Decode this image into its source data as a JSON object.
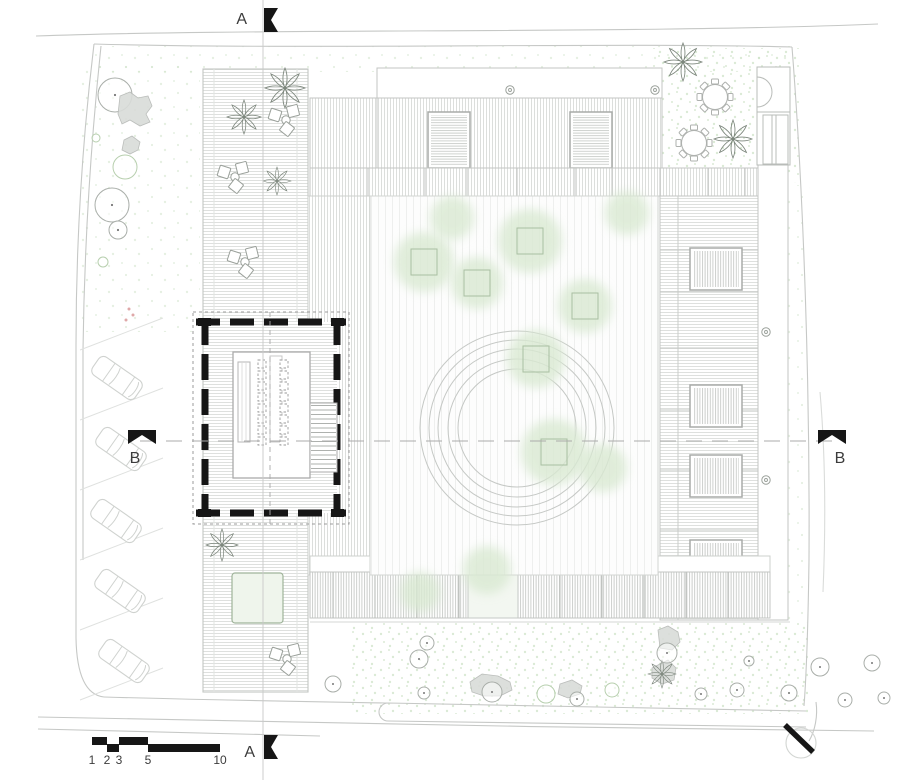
{
  "document": {
    "type": "architectural-site-plan"
  },
  "colors": {
    "black": "#161616",
    "line": "#b9bcb9",
    "light_line": "#d2d5d2",
    "faint_line": "#dfe1df",
    "boundary": "#c6c8c6",
    "canopy": "#d9e9d2",
    "stipple": "#cbe0c3",
    "planter": "#a9bfa2",
    "car": "#cfd2cf",
    "tree_ring": "#a9aea9",
    "tree_ring_green": "#b7cfae",
    "text": "#3c3c3c"
  },
  "markers": {
    "a_top": {
      "label": "A"
    },
    "a_bottom": {
      "label": "A"
    },
    "b_left": {
      "label": "B"
    },
    "b_right": {
      "label": "B"
    }
  },
  "scale_bar": {
    "marks": [
      {
        "label": "1",
        "x": 92
      },
      {
        "label": "2",
        "x": 107
      },
      {
        "label": "3",
        "x": 119
      },
      {
        "label": "5",
        "x": 148
      },
      {
        "label": "10",
        "x": 220
      }
    ],
    "segments": [
      {
        "x1": 92,
        "x2": 107,
        "row": "top"
      },
      {
        "x1": 107,
        "x2": 119,
        "row": "bottom"
      },
      {
        "x1": 119,
        "x2": 148,
        "row": "top"
      },
      {
        "x1": 148,
        "x2": 220,
        "row": "bottom"
      }
    ]
  },
  "parking": {
    "stalls": [
      [
        80,
        350,
        163,
        318
      ],
      [
        80,
        420,
        163,
        388
      ],
      [
        80,
        490,
        163,
        458
      ],
      [
        80,
        560,
        163,
        528
      ],
      [
        80,
        630,
        163,
        598
      ],
      [
        80,
        700,
        163,
        668
      ]
    ],
    "cars": [
      {
        "x": 117,
        "y": 378,
        "a": 35
      },
      {
        "x": 121,
        "y": 449,
        "a": 35
      },
      {
        "x": 116,
        "y": 521,
        "a": 35
      },
      {
        "x": 120,
        "y": 591,
        "a": 35
      },
      {
        "x": 124,
        "y": 661,
        "a": 35
      }
    ]
  },
  "landscape": {
    "courtyard_trees": [
      {
        "x": 424,
        "y": 262,
        "r": 30,
        "planter": true
      },
      {
        "x": 477,
        "y": 283,
        "r": 26,
        "planter": true
      },
      {
        "x": 530,
        "y": 241,
        "r": 32,
        "planter": true
      },
      {
        "x": 585,
        "y": 306,
        "r": 27,
        "planter": true
      },
      {
        "x": 536,
        "y": 359,
        "r": 29,
        "planter": true
      },
      {
        "x": 554,
        "y": 452,
        "r": 33,
        "planter": true
      },
      {
        "x": 452,
        "y": 218,
        "r": 22,
        "planter": false
      },
      {
        "x": 603,
        "y": 468,
        "r": 24,
        "planter": false
      },
      {
        "x": 627,
        "y": 213,
        "r": 22,
        "planter": false
      },
      {
        "x": 487,
        "y": 570,
        "r": 24,
        "planter": false
      },
      {
        "x": 420,
        "y": 592,
        "r": 20,
        "planter": false
      }
    ],
    "perimeter_trees": [
      {
        "x": 115,
        "y": 95,
        "r": 17,
        "dot": true
      },
      {
        "x": 112,
        "y": 205,
        "r": 17,
        "dot": true
      },
      {
        "x": 118,
        "y": 230,
        "r": 9,
        "dot": true
      },
      {
        "x": 125,
        "y": 167,
        "r": 12,
        "green": true
      },
      {
        "x": 103,
        "y": 262,
        "r": 5,
        "green": true
      },
      {
        "x": 96,
        "y": 138,
        "r": 4,
        "green": true
      }
    ],
    "garden_trees": [
      {
        "x": 427,
        "y": 643,
        "r": 7,
        "dot": true
      },
      {
        "x": 419,
        "y": 659,
        "r": 9,
        "dot": true
      },
      {
        "x": 333,
        "y": 684,
        "r": 8,
        "dot": true
      },
      {
        "x": 424,
        "y": 693,
        "r": 6,
        "dot": true
      },
      {
        "x": 492,
        "y": 692,
        "r": 10,
        "dot": true
      },
      {
        "x": 546,
        "y": 694,
        "r": 9,
        "green": true
      },
      {
        "x": 577,
        "y": 699,
        "r": 7,
        "dot": true
      },
      {
        "x": 612,
        "y": 690,
        "r": 7,
        "green": true
      },
      {
        "x": 667,
        "y": 653,
        "r": 10,
        "dot": true
      },
      {
        "x": 701,
        "y": 694,
        "r": 6,
        "dot": true
      },
      {
        "x": 737,
        "y": 690,
        "r": 7,
        "dot": true
      },
      {
        "x": 749,
        "y": 661,
        "r": 5,
        "dot": true
      },
      {
        "x": 789,
        "y": 693,
        "r": 8,
        "dot": true
      },
      {
        "x": 820,
        "y": 667,
        "r": 9,
        "dot": true
      },
      {
        "x": 845,
        "y": 700,
        "r": 7,
        "dot": true
      },
      {
        "x": 872,
        "y": 663,
        "r": 8,
        "dot": true
      },
      {
        "x": 884,
        "y": 698,
        "r": 6,
        "dot": true
      }
    ],
    "palms": [
      {
        "x": 285,
        "y": 88,
        "s": 1.0
      },
      {
        "x": 244,
        "y": 117,
        "s": 0.85
      },
      {
        "x": 277,
        "y": 181,
        "s": 0.7
      },
      {
        "x": 222,
        "y": 545,
        "s": 0.8
      },
      {
        "x": 683,
        "y": 62,
        "s": 0.95
      },
      {
        "x": 733,
        "y": 139,
        "s": 0.95
      },
      {
        "x": 662,
        "y": 674,
        "s": 0.7
      }
    ],
    "blobs": [
      "120,96 130,92 138,98 148,96 152,106 146,114 150,122 140,126 130,120 122,124 118,114",
      "124,140 132,136 140,142 138,150 130,154 122,150",
      "470,682 482,674 498,676 510,682 512,690 500,696 484,696 472,692",
      "560,684 572,680 582,686 580,694 568,698 558,694",
      "658,630 668,626 678,632 680,642 672,650 660,648",
      "652,668 668,660 676,668 674,680 662,684 652,678",
      "922,190 936,184 946,192 944,204 930,208 920,200"
    ],
    "pink_dots": [
      [
        129,
        309
      ],
      [
        133,
        315
      ],
      [
        126,
        320
      ]
    ]
  },
  "furniture": {
    "chair_clusters": [
      {
        "x": 286,
        "y": 120
      },
      {
        "x": 235,
        "y": 177
      },
      {
        "x": 245,
        "y": 262
      },
      {
        "x": 287,
        "y": 659
      }
    ],
    "round_tables": [
      {
        "x": 715,
        "y": 97
      },
      {
        "x": 694,
        "y": 143
      }
    ],
    "room_chairs": {
      "cols": [
        262,
        284
      ],
      "y0": 360,
      "step": 11,
      "n": 8,
      "size": 8
    }
  },
  "structure": {
    "drains": [
      [
        510,
        90
      ],
      [
        655,
        90
      ],
      [
        766,
        332
      ],
      [
        766,
        480
      ]
    ],
    "band_dividers_x": [
      368,
      425,
      467,
      517,
      575,
      612,
      660,
      708,
      745
    ],
    "bottom_wing_dividers_x": [
      333,
      375,
      417,
      459,
      518,
      560,
      602,
      644,
      686,
      728
    ],
    "right_wing_dividers_y": [
      250,
      292,
      348,
      410,
      470,
      530
    ],
    "courtyard_circle_radii": [
      97,
      88,
      79,
      69,
      59
    ],
    "courtyard_circle_center": {
      "x": 517,
      "y": 428
    }
  }
}
